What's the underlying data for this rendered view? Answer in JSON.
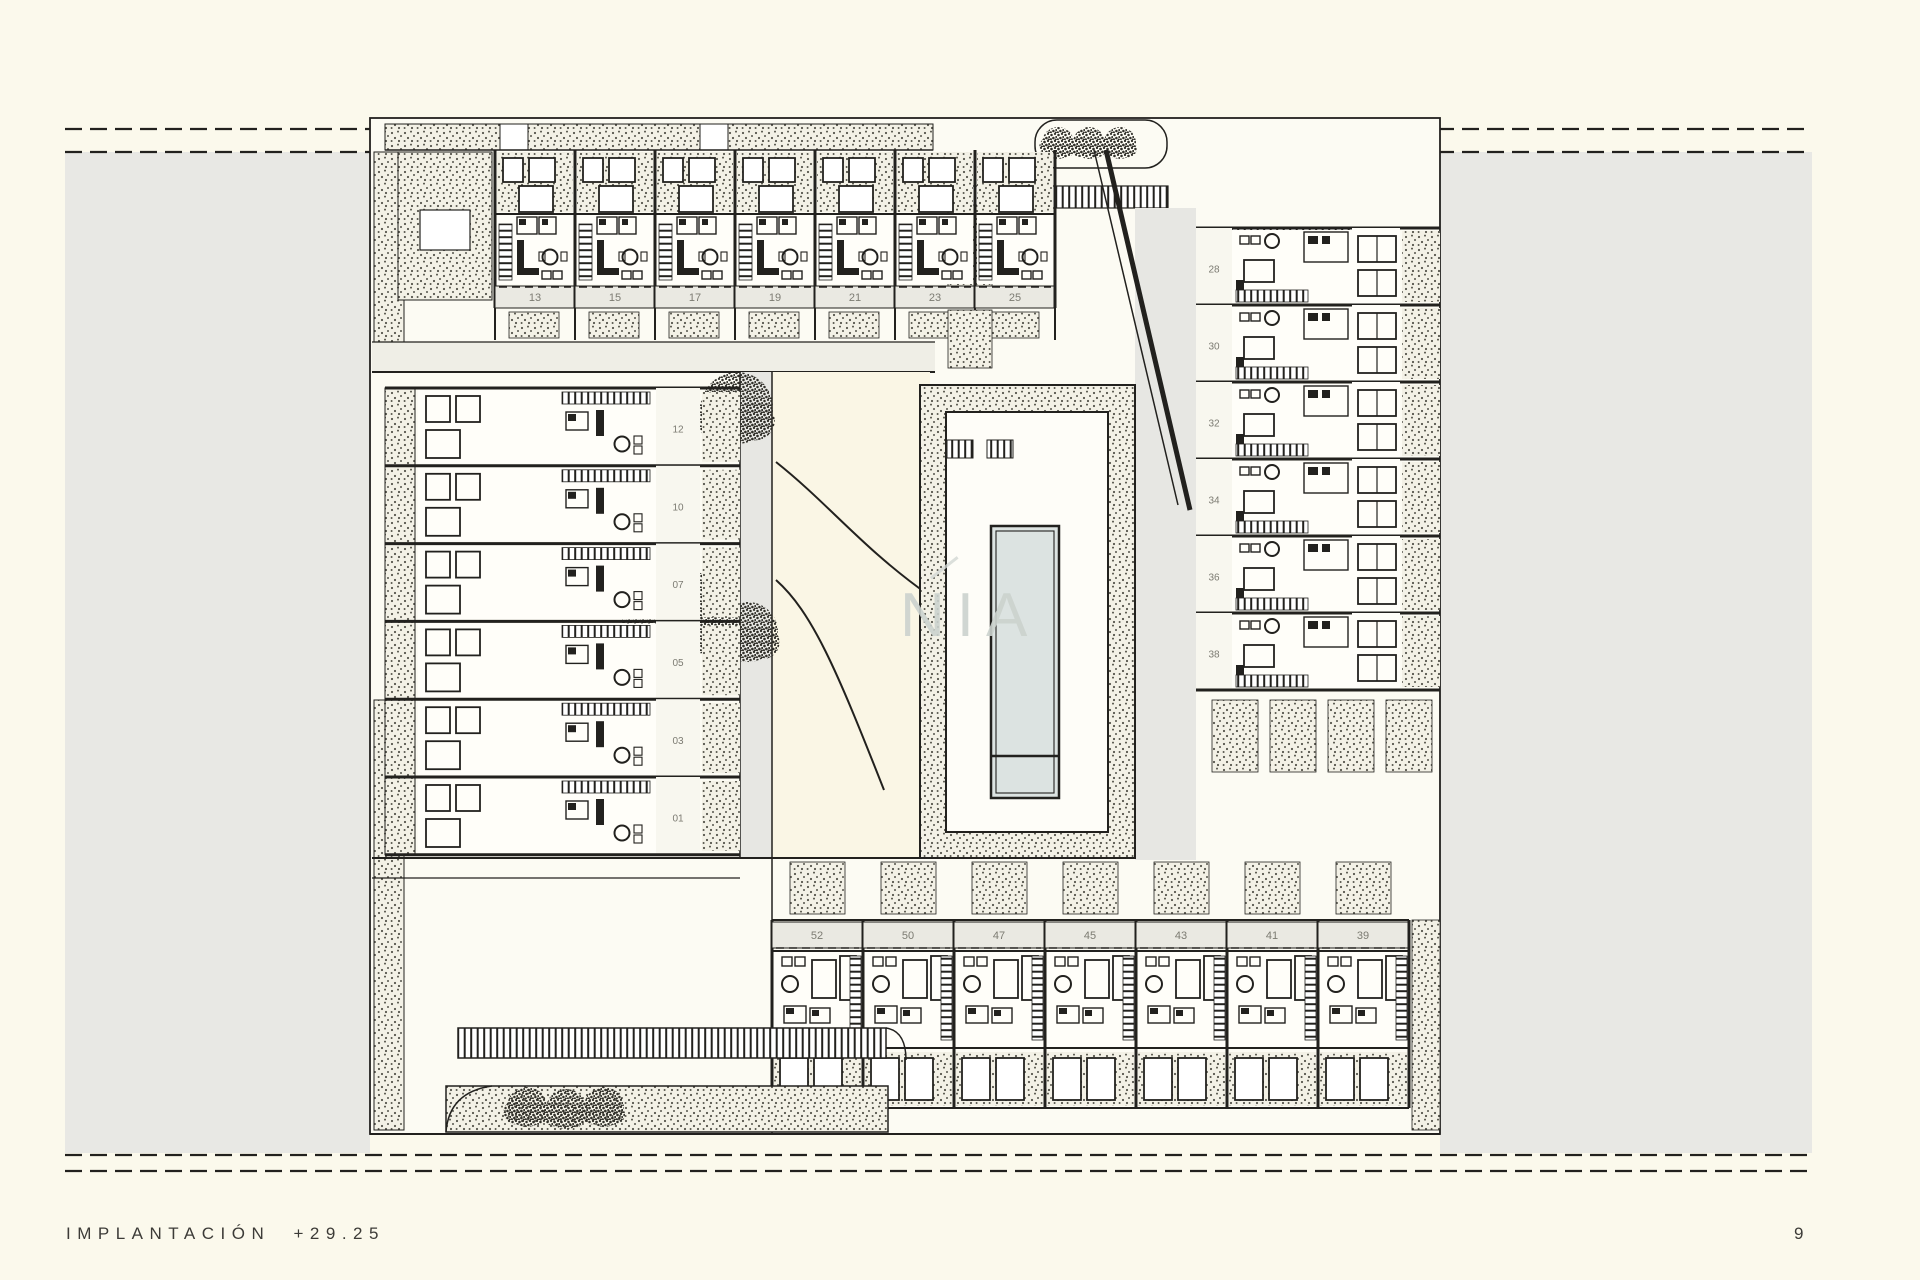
{
  "page": {
    "title": "MIRASAL II",
    "footer_label": "IMPLANTACIÓN +29.25",
    "page_number": "9",
    "watermark": "NIA"
  },
  "plan": {
    "top_row_units": [
      "13",
      "15",
      "17",
      "19",
      "21",
      "23",
      "25"
    ],
    "right_column_units": [
      "28",
      "30",
      "32",
      "34",
      "36",
      "38"
    ],
    "left_column_units": [
      "12",
      "10",
      "07",
      "05",
      "03",
      "01"
    ],
    "bottom_row_units": [
      "52",
      "50",
      "47",
      "45",
      "43",
      "41",
      "39"
    ],
    "colors": {
      "ink": "#22211e",
      "paper": "#fbf9ec",
      "plan_paper": "#fcfbf3",
      "room_paper": "#fffef9",
      "grey_band": "#e8e8e4",
      "label_band": "#eae9e2",
      "number_lane": "#f8f7ef",
      "garden": "#faf6e5",
      "lane_grey": "#e7e7e3",
      "pool_water": "#dce3e1",
      "unit_number_text": "#7c7b72",
      "title_text": "#3c3b37"
    }
  }
}
